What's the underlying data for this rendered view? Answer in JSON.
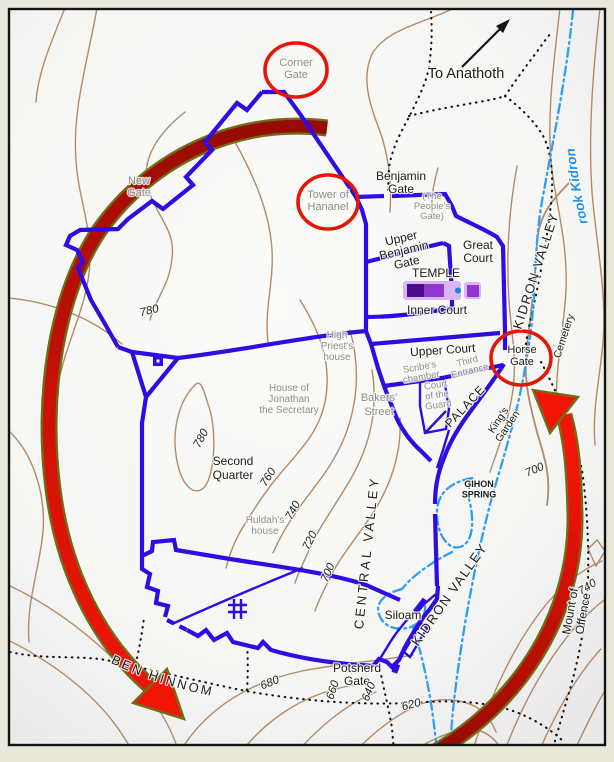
{
  "map": {
    "description": "Map of ancient Jerusalem with city walls, gates, valleys and contour lines",
    "colors": {
      "frame": "#141414",
      "paper": "#e8e8da",
      "mapbg": "#f9f9f8",
      "contour": "#b38a67",
      "wall": "#2e0ce2",
      "water": "#2e9df5",
      "road": "#141414",
      "circle": "#e61507",
      "arrowDark": "#970b02",
      "arrowBright": "#f31408",
      "olive": "#6f6e16",
      "grayLabel": "#8d8d8d",
      "blackLabel": "#1c1c1c",
      "blueLabel": "#1e90e8",
      "templeBase": "#d9b5f2",
      "templeDark": "#4a0d8f",
      "templeMid": "#9137cf",
      "templeDot": "#1c7fe8"
    },
    "highlight_circles": [
      "Corner Gate",
      "Tower of Hananel",
      "Horse Gate"
    ],
    "labels": [
      {
        "id": "corner-gate",
        "cls": "g11",
        "x": 296,
        "y": 66,
        "lines": [
          "Corner",
          "Gate"
        ]
      },
      {
        "id": "to-anathoth",
        "cls": "b14",
        "x": 466,
        "y": 78,
        "text": "To Anathoth"
      },
      {
        "id": "brook-kidron",
        "cls": "blue-it",
        "pathRef": "brook-text-path",
        "offset": "10%",
        "text": "The Brook Kidron"
      },
      {
        "id": "new-gate",
        "cls": "g11",
        "x": 139,
        "y": 184,
        "lines": [
          "New",
          "Gate"
        ]
      },
      {
        "id": "tower-of-hananel",
        "cls": "g11",
        "x": 328,
        "y": 198,
        "lines": [
          "Tower of",
          "Hananel"
        ]
      },
      {
        "id": "benjamin-gate",
        "cls": "b12",
        "x": 401,
        "y": 180,
        "lines": [
          "Benjamin",
          "Gate"
        ],
        "lh": 13
      },
      {
        "id": "peoples-gate",
        "cls": "g9",
        "x": 432,
        "y": 199,
        "lines": [
          "(The",
          "People's",
          "Gate)"
        ],
        "lh": 10
      },
      {
        "id": "upper-benjamin-gate",
        "cls": "b12",
        "x": 402,
        "y": 242,
        "rot": -13,
        "lines": [
          "Upper",
          "Benjamin",
          "Gate"
        ],
        "lh": 12.5
      },
      {
        "id": "great-court",
        "cls": "b12",
        "x": 478,
        "y": 249,
        "lines": [
          "Great",
          "Court"
        ],
        "lh": 13
      },
      {
        "id": "temple",
        "cls": "b12",
        "x": 436,
        "y": 277,
        "text": "TEMPLE"
      },
      {
        "id": "inner-court",
        "cls": "b12",
        "x": 437,
        "y": 314,
        "text": "Inner Court"
      },
      {
        "id": "kidron-valley-upper",
        "cls": "b13",
        "x": 540,
        "y": 272,
        "rot": -72,
        "ls": 1.5,
        "text": "KIDRON VALLEY"
      },
      {
        "id": "cemetery",
        "cls": "b10",
        "x": 567,
        "y": 337,
        "rot": -72,
        "text": "Cemetery"
      },
      {
        "id": "upper-court",
        "cls": "b12",
        "x": 443,
        "y": 354,
        "rot": -4,
        "text": "Upper Court"
      },
      {
        "id": "scribes-chamber",
        "cls": "g9",
        "x": 420,
        "y": 370,
        "rot": -10,
        "lines": [
          "Scribe's",
          "chamber"
        ],
        "lh": 10
      },
      {
        "id": "third-entrance",
        "cls": "g9",
        "x": 468,
        "y": 364,
        "rot": -14,
        "lines": [
          "Third",
          "Entrance"
        ],
        "lh": 10
      },
      {
        "id": "horse-gate",
        "cls": "b11",
        "x": 522,
        "y": 353,
        "lines": [
          "Horse",
          "Gate"
        ],
        "lh": 12
      },
      {
        "id": "high-priests-house",
        "cls": "g10",
        "x": 337,
        "y": 338,
        "lines": [
          "High",
          "Priest's",
          "house"
        ],
        "lh": 11
      },
      {
        "id": "court-of-the-guard",
        "cls": "g9",
        "x": 436,
        "y": 388,
        "rot": -8,
        "lines": [
          "Court",
          "of the",
          "Guard"
        ],
        "lh": 10
      },
      {
        "id": "house-of-jonathan",
        "cls": "g10",
        "x": 289,
        "y": 391,
        "lines": [
          "House of",
          "Jonathan",
          "the Secretary"
        ],
        "lh": 11
      },
      {
        "id": "bakers-street",
        "cls": "g11",
        "x": 379,
        "y": 401,
        "lines": [
          "Bakers'",
          "Street"
        ],
        "lh": 14
      },
      {
        "id": "palace",
        "cls": "b12",
        "x": 468,
        "y": 409,
        "rot": -47,
        "ls": 1,
        "text": "PALACE"
      },
      {
        "id": "kings-garden",
        "cls": "b10",
        "x": 501,
        "y": 422,
        "rot": -56,
        "lines": [
          "King's",
          "Garden"
        ],
        "lh": 11
      },
      {
        "id": "second-quarter",
        "cls": "b12",
        "x": 233,
        "y": 465,
        "lines": [
          "Second",
          "Quarter"
        ],
        "lh": 14
      },
      {
        "id": "gihon-spring",
        "cls": "b9",
        "x": 479,
        "y": 487,
        "lines": [
          "GIHON",
          "SPRING"
        ],
        "lh": 10.5
      },
      {
        "id": "huldahs-house",
        "cls": "g10",
        "x": 265,
        "y": 523,
        "lines": [
          "Huldah's",
          "house"
        ],
        "lh": 11
      },
      {
        "id": "central-valley",
        "cls": "b13",
        "x": 371,
        "y": 553,
        "rot": -84,
        "ls": 3,
        "text": "CENTRAL VALLEY"
      },
      {
        "id": "kidron-valley-lower",
        "cls": "b13",
        "x": 453,
        "y": 597,
        "rot": -55,
        "ls": 1.5,
        "text": "KIDRON VALLEY"
      },
      {
        "id": "siloam",
        "cls": "b12",
        "x": 403,
        "y": 619,
        "text": "Siloam"
      },
      {
        "id": "mount-of-offence",
        "cls": "b12",
        "x": 574,
        "y": 612,
        "rot": -80,
        "lines": [
          "Mount of",
          "Offence"
        ],
        "lh": 13
      },
      {
        "id": "potsherd-gate",
        "cls": "b12",
        "x": 357,
        "y": 672,
        "lines": [
          "Potsherd",
          "Gate"
        ],
        "lh": 13
      },
      {
        "id": "valley-of-ben-hinnom",
        "cls": "b13",
        "pathRef": "hinnom-text-path",
        "offset": "3%",
        "ls": 2.5,
        "text": "VALLEY OF BEN HINNOM"
      },
      {
        "id": "contour-780-a",
        "cls": "c11",
        "x": 150,
        "y": 314,
        "rot": -14,
        "text": "780"
      },
      {
        "id": "contour-780-b",
        "cls": "c11",
        "x": 204,
        "y": 440,
        "rot": -62,
        "text": "780"
      },
      {
        "id": "contour-760",
        "cls": "c11",
        "x": 271,
        "y": 479,
        "rot": -58,
        "text": "760"
      },
      {
        "id": "contour-740",
        "cls": "c11",
        "x": 296,
        "y": 512,
        "rot": -62,
        "text": "740"
      },
      {
        "id": "contour-720",
        "cls": "c11",
        "x": 313,
        "y": 542,
        "rot": -64,
        "text": "720"
      },
      {
        "id": "contour-700",
        "cls": "c11",
        "x": 331,
        "y": 574,
        "rot": -66,
        "text": "700"
      },
      {
        "id": "contour-700-east",
        "cls": "c11",
        "x": 536,
        "y": 473,
        "rot": -24,
        "text": "700"
      },
      {
        "id": "contour-740-east",
        "cls": "c11",
        "x": 589,
        "y": 590,
        "rot": -32,
        "text": "740"
      },
      {
        "id": "contour-680",
        "cls": "c11",
        "x": 271,
        "y": 686,
        "rot": -22,
        "text": "680"
      },
      {
        "id": "contour-660",
        "cls": "c11",
        "x": 336,
        "y": 691,
        "rot": -72,
        "text": "660"
      },
      {
        "id": "contour-640",
        "cls": "c11",
        "x": 372,
        "y": 693,
        "rot": -68,
        "text": "640"
      },
      {
        "id": "contour-620",
        "cls": "c11",
        "x": 412,
        "y": 708,
        "rot": -14,
        "text": "620"
      }
    ]
  }
}
